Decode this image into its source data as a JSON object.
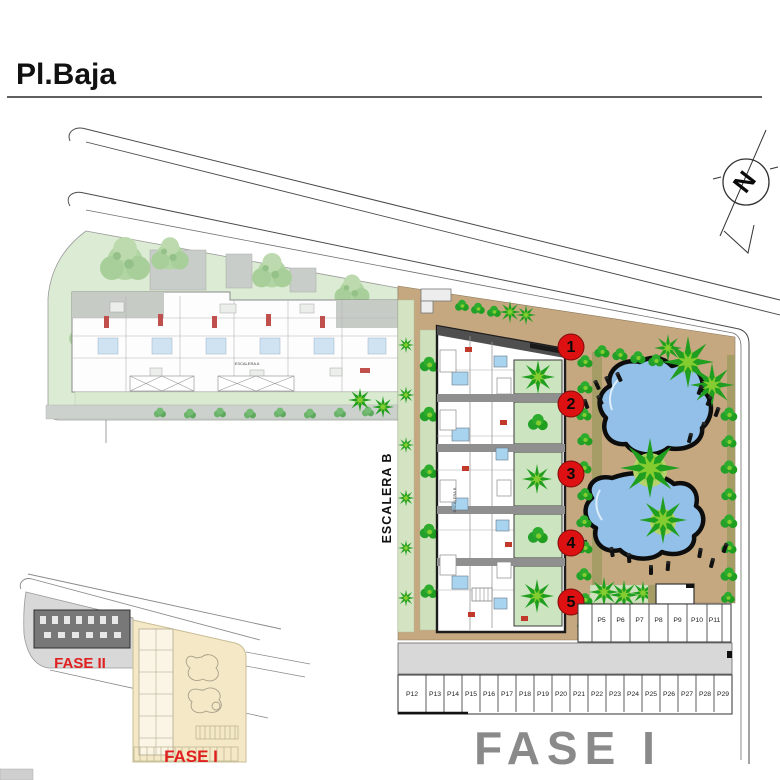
{
  "page": {
    "title": "Pl.Baja"
  },
  "compass": {
    "label": "N"
  },
  "plan": {
    "escalera_b_label": "ESCALERA B",
    "escalera_a_label": "ESCALERA A",
    "phase_label_large": "FASE I",
    "unit_markers": [
      "1",
      "2",
      "3",
      "4",
      "5"
    ],
    "parking_row_upper": [
      "P5",
      "P6",
      "P7",
      "P8",
      "P9",
      "P10",
      "P11"
    ],
    "parking_row_lower": [
      "P12",
      "P13",
      "P14",
      "P15",
      "P16",
      "P17",
      "P18",
      "P19",
      "P20",
      "P21",
      "P22",
      "P23",
      "P24",
      "P25",
      "P26",
      "P27",
      "P28",
      "P29"
    ]
  },
  "inset": {
    "fase2_label": "FASE II",
    "fase1_label": "FASE I"
  },
  "colors": {
    "parcel_tan": "#c6a880",
    "pool_blue": "#92c0e8",
    "palm_green": "#1f9e1f",
    "palm_light": "#85cc30",
    "fase2_parcel_green": "#dcebd3",
    "patio_green": "#cde4c0",
    "marker_red": "#dd1111",
    "phase_text_red": "#e02020",
    "phase_text_grey": "#8a8a8a"
  }
}
